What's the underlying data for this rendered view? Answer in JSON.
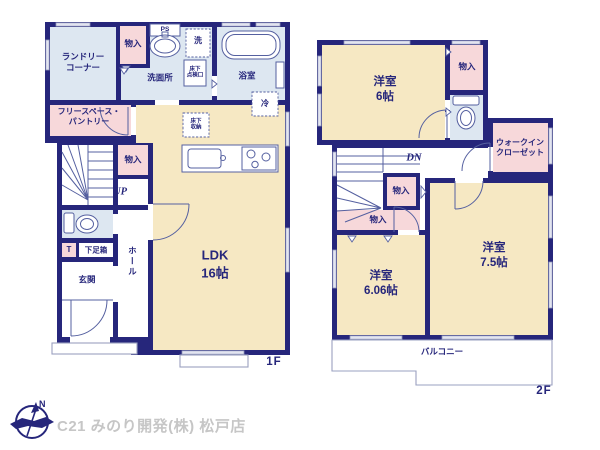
{
  "colors": {
    "wall": "#26267b",
    "ink": "#26267b",
    "room_blue": "#dde7f1",
    "room_pink": "#f7d8da",
    "room_cream": "#f6e8c3",
    "line": "#5560a0",
    "window_fill": "#e3e5f0",
    "window_stroke": "#9096bb",
    "outline_thin": "#9aa0c0",
    "footer_text": "#c6c6c6"
  },
  "floor1": {
    "label": "1F",
    "laundry": "ランドリー\nコーナー",
    "storage_a": "物入",
    "ps": "PS",
    "washroom": "洗面所",
    "washer": "洗",
    "inspection": "床下\n点検口",
    "bath": "浴室",
    "fridge": "冷",
    "freespace": "フリースペース・\nパントリー",
    "storage_b": "物入",
    "up": "UP",
    "underfloor": "床下\n収納",
    "ldk": "LDK\n16帖",
    "t": "T",
    "shoebox": "下足箱",
    "entrance": "玄関",
    "hall": "ホール"
  },
  "floor2": {
    "label": "2F",
    "room6": "洋室\n6帖",
    "storage_a": "物入",
    "wic": "ウォークイン\nクローゼット",
    "dn": "DN",
    "storage_b": "物入",
    "storage_c": "物入",
    "room606": "洋室\n6.06帖",
    "room75": "洋室\n7.5帖",
    "balcony": "バルコニー"
  },
  "footer": {
    "company": "C21 みのり開発(株) 松戸店",
    "north": "N"
  }
}
